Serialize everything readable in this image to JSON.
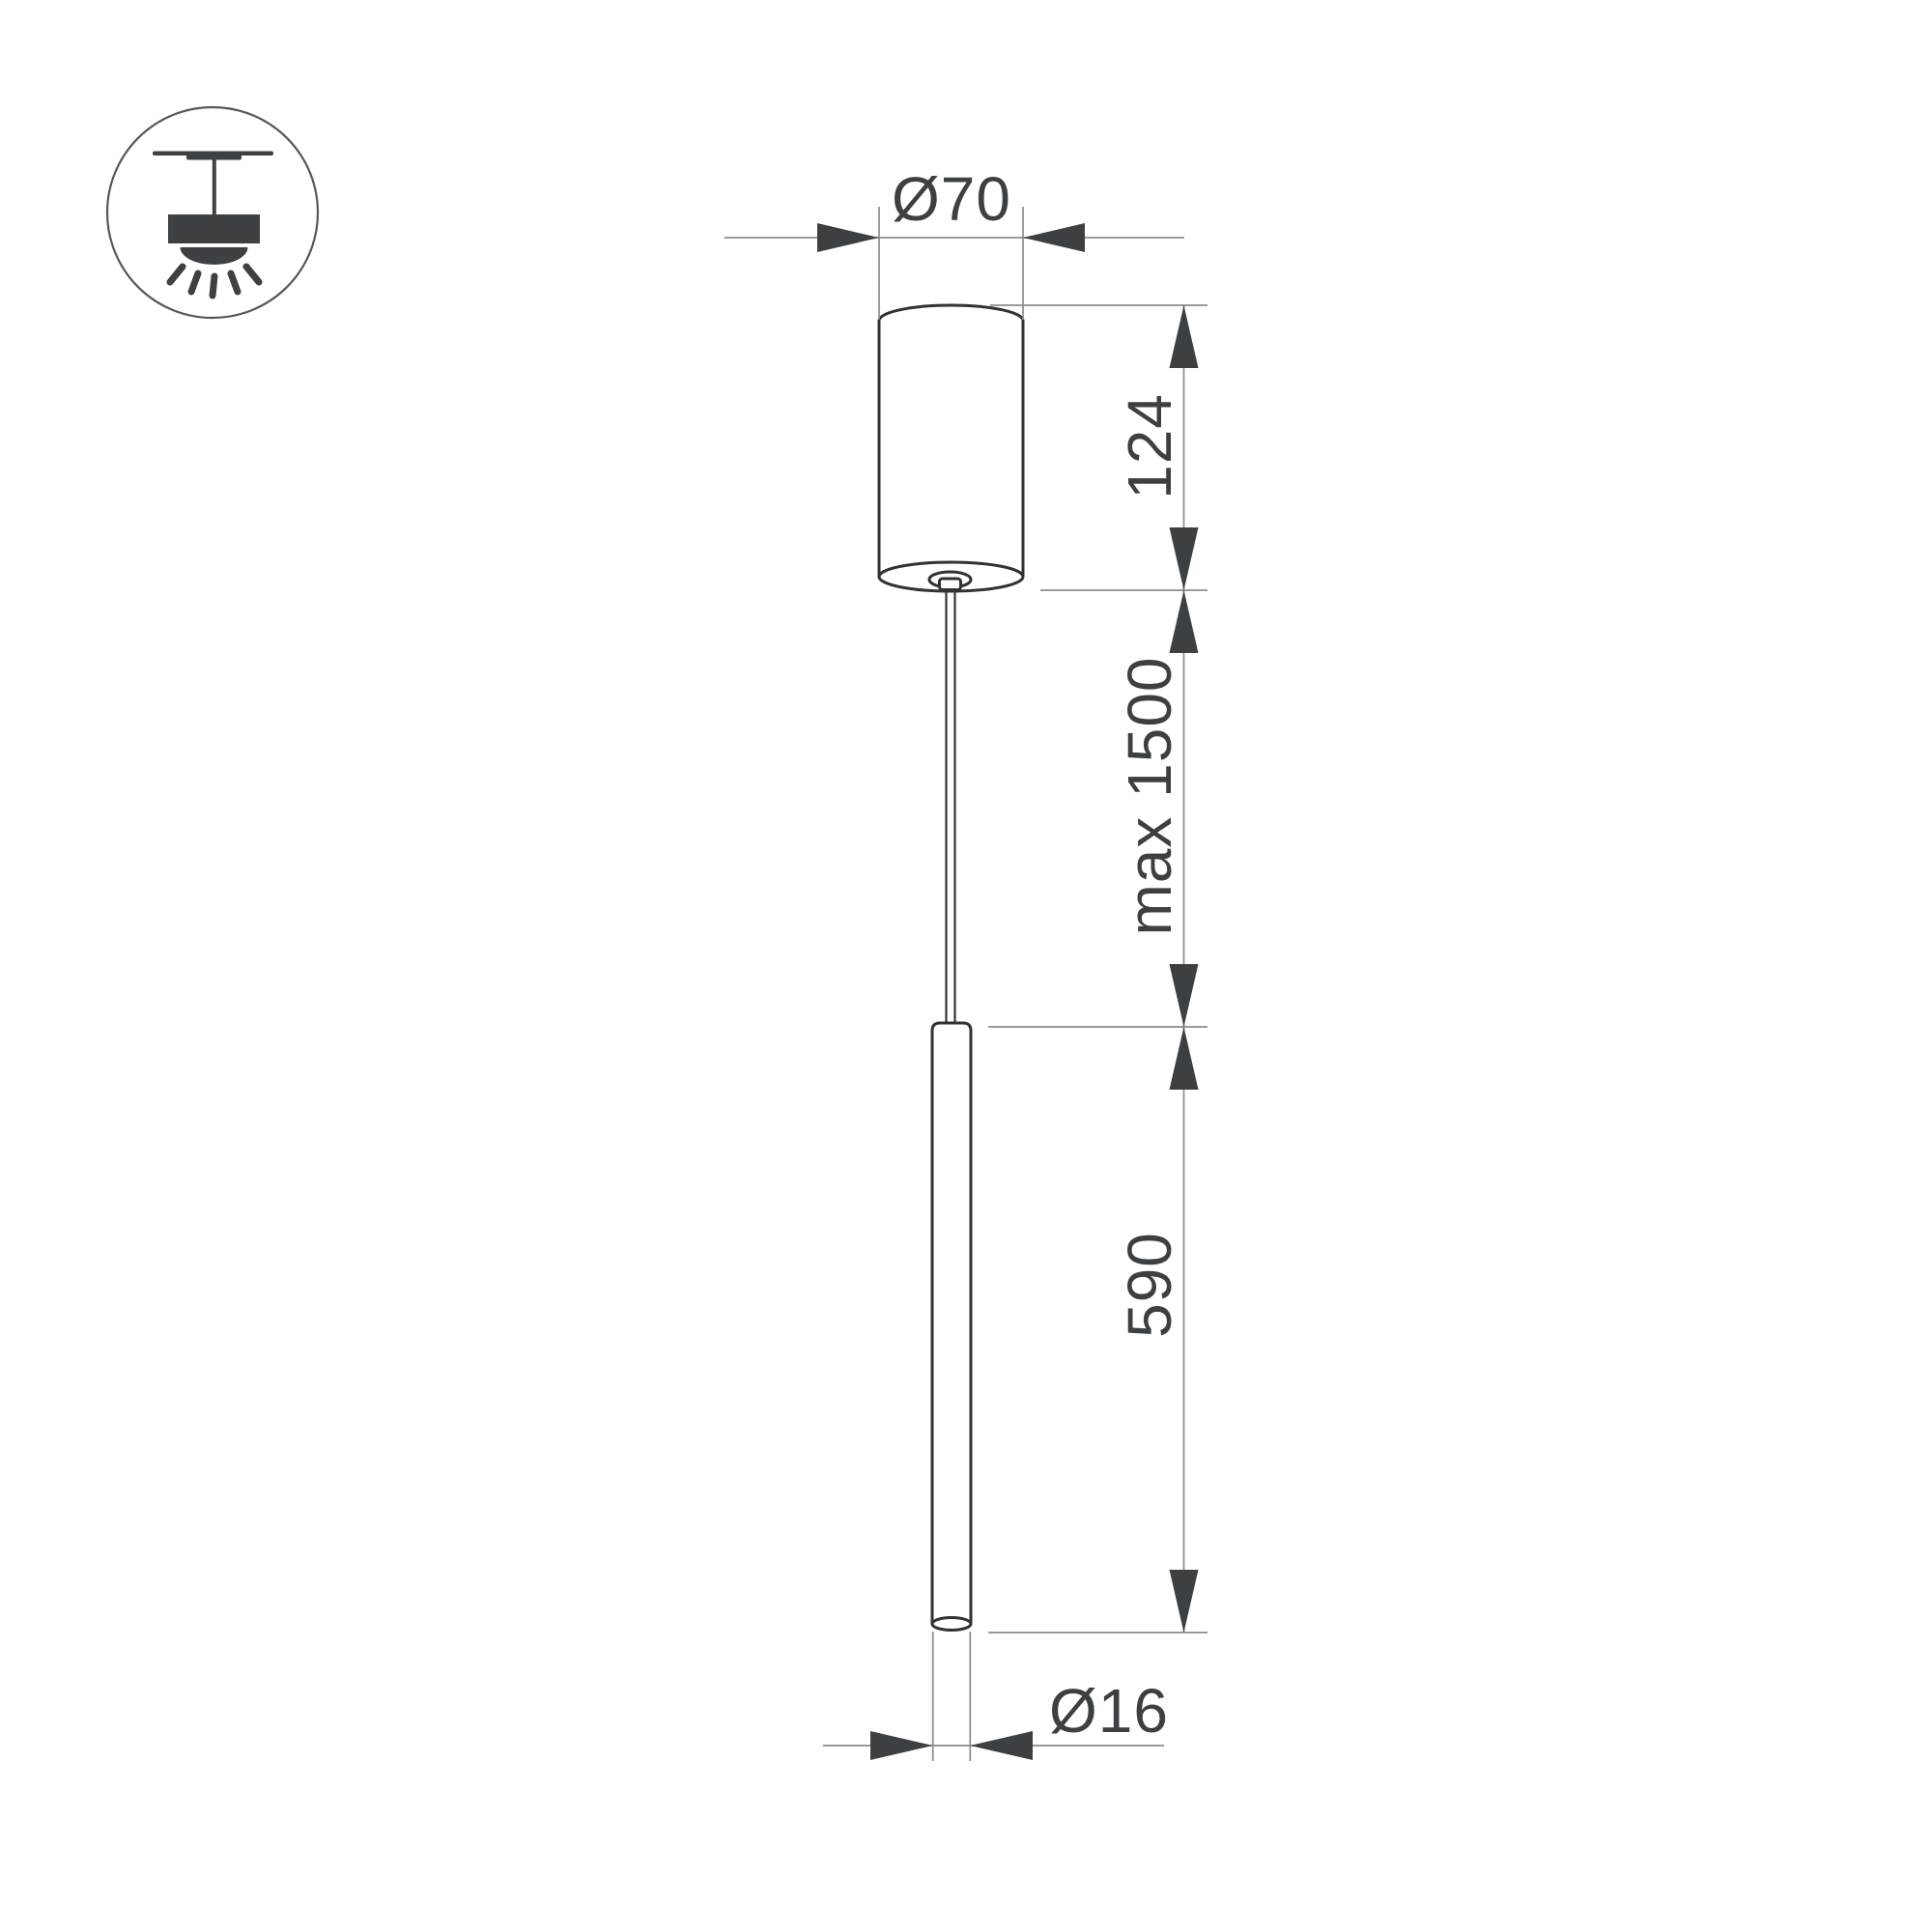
{
  "colors": {
    "background": "#ffffff",
    "object_stroke": "#2f3336",
    "dimension_line": "#8a8d90",
    "arrow_and_text": "#3c4043",
    "icon": "#3d4144"
  },
  "legend_icon": {
    "name": "ceiling-pendant-mount-icon"
  },
  "dimensions": {
    "canopy_diameter_label": "Ø70",
    "canopy_height_label": "124",
    "suspension_max_label": "max 1500",
    "luminaire_length_label": "590",
    "tube_diameter_label": "Ø16"
  }
}
